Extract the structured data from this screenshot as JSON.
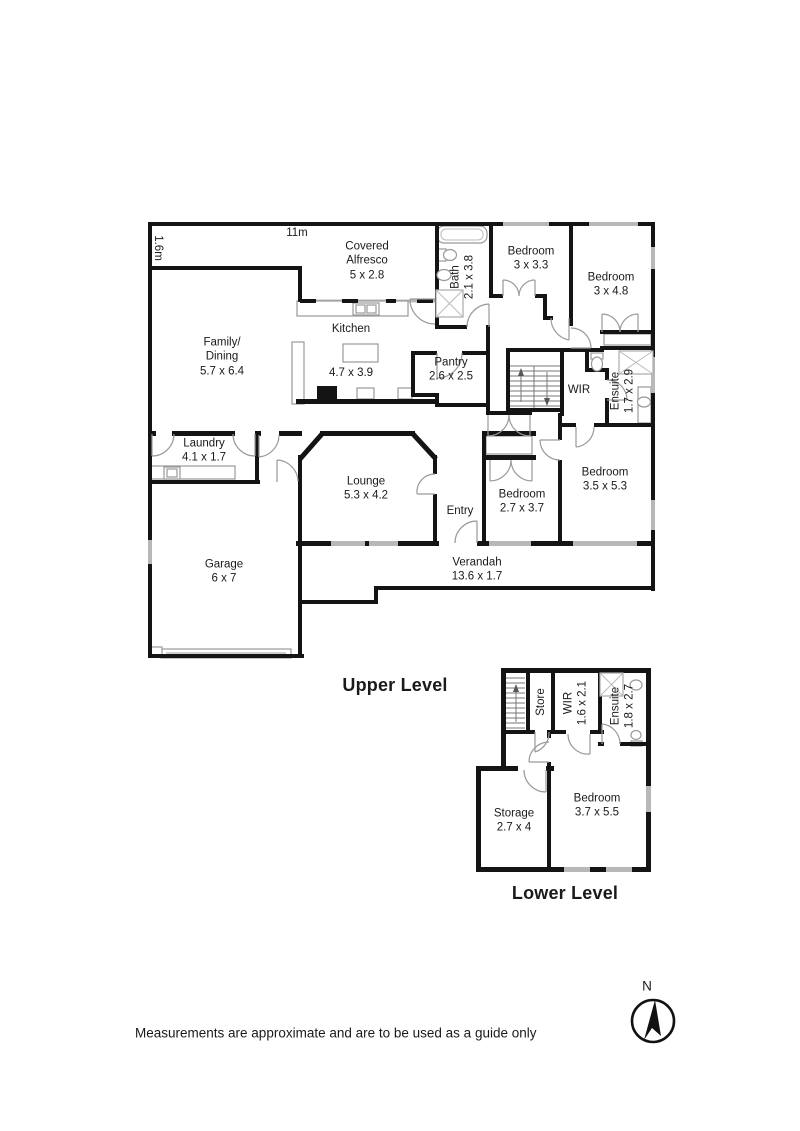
{
  "page": {
    "disclaimer": "Measurements are approximate and are to be used as a guide only"
  },
  "compass": {
    "label": "N"
  },
  "upper": {
    "title": "Upper Level",
    "dim_width": "11m",
    "dim_strip": "1.6m",
    "rooms": {
      "alfresco": {
        "lines": [
          "Covered",
          "Alfresco",
          "5 x 2.8"
        ]
      },
      "bath": {
        "lines": [
          "Bath",
          "2.1 x 3.8"
        ]
      },
      "bedroom1": {
        "lines": [
          "Bedroom",
          "3 x 3.3"
        ]
      },
      "bedroom2": {
        "lines": [
          "Bedroom",
          "3 x 4.8"
        ]
      },
      "family": {
        "lines": [
          "Family/",
          "Dining",
          "5.7 x 6.4"
        ]
      },
      "kitchen": {
        "lines": [
          "Kitchen"
        ]
      },
      "kitchen_dims": {
        "lines": [
          "4.7 x 3.9"
        ]
      },
      "pantry": {
        "lines": [
          "Pantry",
          "2.6 x 2.5"
        ]
      },
      "wir": {
        "lines": [
          "WIR"
        ]
      },
      "ensuite": {
        "lines": [
          "Ensuite",
          "1.7 x 2.9"
        ]
      },
      "laundry": {
        "lines": [
          "Laundry",
          "4.1 x 1.7"
        ]
      },
      "lounge": {
        "lines": [
          "Lounge",
          "5.3 x 4.2"
        ]
      },
      "entry": {
        "lines": [
          "Entry"
        ]
      },
      "bedroom3": {
        "lines": [
          "Bedroom",
          "2.7 x 3.7"
        ]
      },
      "bedroom4": {
        "lines": [
          "Bedroom",
          "3.5 x 5.3"
        ]
      },
      "garage": {
        "lines": [
          "Garage",
          "6 x 7"
        ]
      },
      "verandah": {
        "lines": [
          "Verandah",
          "13.6 x 1.7"
        ]
      }
    }
  },
  "lower": {
    "title": "Lower Level",
    "rooms": {
      "store": {
        "lines": [
          "Store"
        ]
      },
      "wir": {
        "lines": [
          "WIR",
          "1.6 x 2.1"
        ]
      },
      "ensuite": {
        "lines": [
          "Ensuite",
          "1.8 x 2.7"
        ]
      },
      "storage": {
        "lines": [
          "Storage",
          "2.7 x 4"
        ]
      },
      "bedroom": {
        "lines": [
          "Bedroom",
          "3.7 x 5.5"
        ]
      }
    }
  }
}
